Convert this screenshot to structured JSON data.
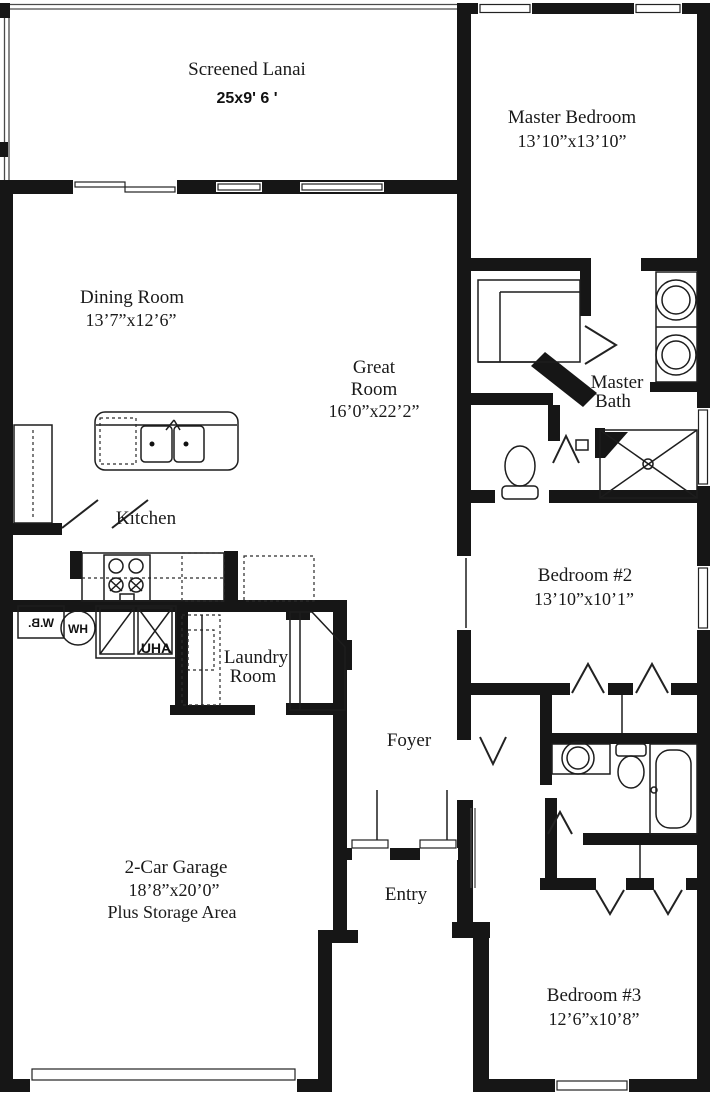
{
  "rooms": {
    "lanai": {
      "name": "Screened Lanai",
      "dims": "25x9' 6 '"
    },
    "master_bedroom": {
      "name": "Master Bedroom",
      "dims": "13’10”x13’10”"
    },
    "dining_room": {
      "name": "Dining Room",
      "dims": "13’7”x12’6”"
    },
    "great_room": {
      "line1": "Great",
      "line2": "Room",
      "dims": "16’0”x22’2”"
    },
    "master_bath": {
      "line1": "Master",
      "line2": "Bath"
    },
    "kitchen": {
      "name": "Kitchen"
    },
    "bedroom2": {
      "name": "Bedroom #2",
      "dims": "13’10”x10’1”"
    },
    "laundry": {
      "line1": "Laundry",
      "line2": "Room"
    },
    "foyer": {
      "name": "Foyer"
    },
    "garage": {
      "name": "2-Car Garage",
      "dims": "18’8”x20’0”",
      "note": "Plus Storage Area"
    },
    "entry": {
      "name": "Entry"
    },
    "bedroom3": {
      "name": "Bedroom #3",
      "dims": "12’6”x10’8”"
    }
  },
  "equipment": {
    "water_heater": "HW",
    "air_handler": "AHU",
    "water_softener": "W.B."
  },
  "colors": {
    "wall": "#161616",
    "background": "#ffffff"
  }
}
